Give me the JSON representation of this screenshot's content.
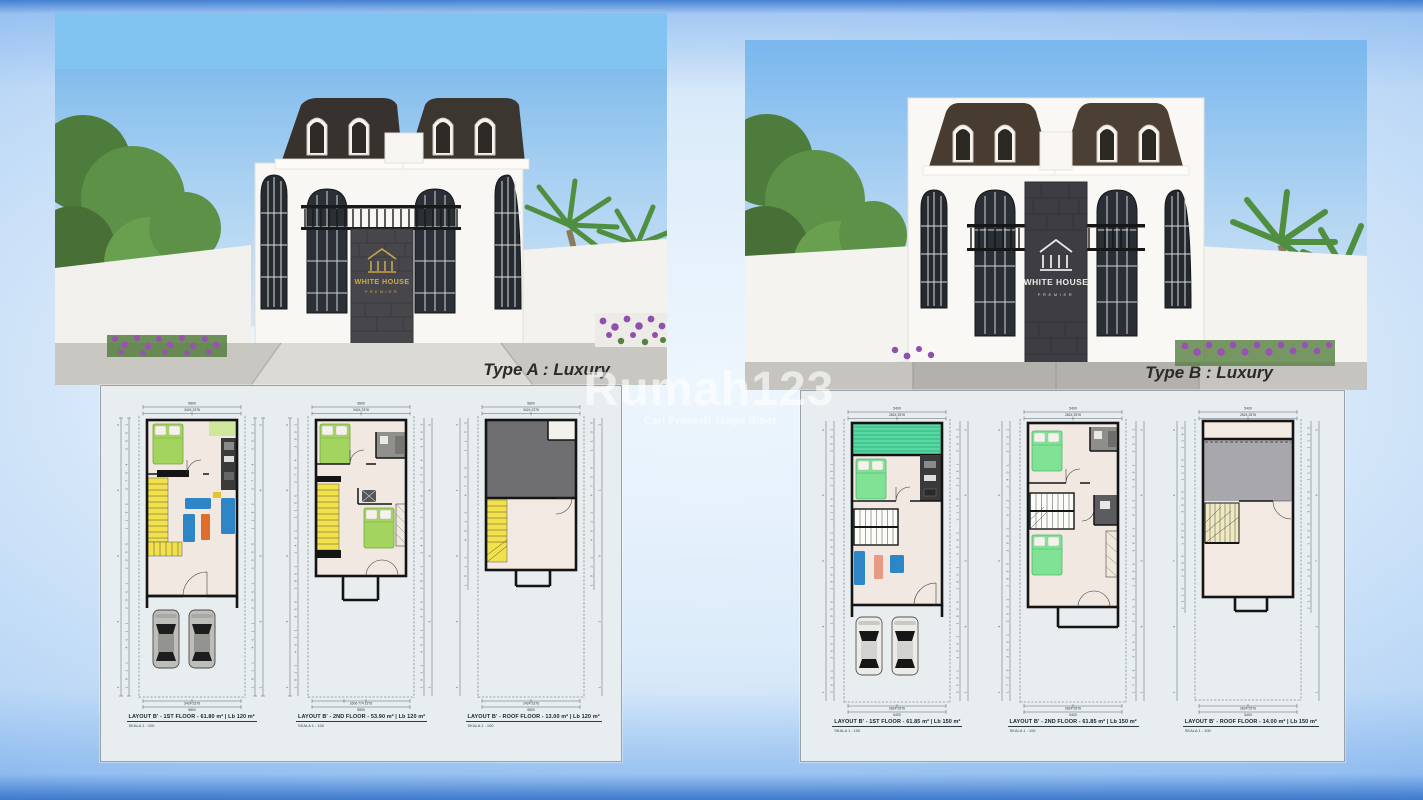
{
  "watermark": {
    "text": "Rumah123",
    "tagline": "Cari Properti Tanpa Ribet"
  },
  "panels": [
    {
      "id": "type-a",
      "caption": "Type A : Luxury",
      "logo": {
        "line1": "WHITE HOUSE",
        "line2": "PREMIER"
      },
      "plans": [
        {
          "label": "LAYOUT B' - 1ST FLOOR - 61.80 m² | Lb 120 m²",
          "scale": "SKALA 1 : 100",
          "dims": {
            "top": "5800",
            "tops": "3424          2376",
            "side_total": "15040",
            "side": "1911  4011  2001  3050  1150  2704  3001",
            "bottoms": "3424          2376",
            "bottom": "5800"
          }
        },
        {
          "label": "LAYOUT B' - 2ND FLOOR - 53.90 m² | Lb 120 m²",
          "scale": "SKALA 1 : 100",
          "dims": {
            "top": "5800",
            "tops": "3424          2376",
            "side_total": "15040",
            "side": "1911  4011  550  2901  1401  1150  2704  3001",
            "bottoms": "1600     774     2276",
            "bottom": "5800"
          }
        },
        {
          "label": "LAYOUT B' - ROOF FLOOR - 13.00 m² | Lb 120 m²",
          "scale": "SKALA 1 : 100",
          "dims": {
            "top": "5800",
            "tops": "3424          2376",
            "side_total": "12011",
            "side": "1911  4011  4750  1150",
            "bottoms": "2424          2376",
            "bottom": "5800"
          }
        }
      ]
    },
    {
      "id": "type-b",
      "caption": "Type B : Luxury",
      "logo": {
        "line1": "WHITE HOUSE",
        "line2": "PREMIER"
      },
      "plans": [
        {
          "label": "LAYOUT B' - 1ST FLOOR - 61.85 m² | Lb 150 m²",
          "scale": "SKALA 1 : 100",
          "dims": {
            "top": "5400",
            "tops": "2824          2576",
            "side_total": "14240",
            "side": "2031  3001  1950  1901  3001  1150  2251  2051",
            "bottoms": "2824          2576",
            "bottom": "5400"
          }
        },
        {
          "label": "LAYOUT B' - 2ND FLOOR - 61.85 m² | Lb 150 m²",
          "scale": "SKALA 1 : 100",
          "dims": {
            "top": "5400",
            "tops": "2824          2576",
            "side_total": "14240",
            "side": "1725  3001  2031  1950  3001  612  1401  2251",
            "bottoms": "2824          2576",
            "bottom": "5400"
          }
        },
        {
          "label": "LAYOUT B' - ROOF FLOOR - 14.00 m² | Lb 150 m²",
          "scale": "SKALA 1 : 100",
          "dims": {
            "top": "5400",
            "tops": "2824          2576",
            "side_total": "12740",
            "side": "2110  3000  1950  3000  1150  1190",
            "bottoms": "2824          2576",
            "bottom": "5400"
          }
        }
      ]
    }
  ],
  "colors": {
    "sky": "#7cbcf0",
    "roof_a": "#37322d",
    "roof_b": "#483c30",
    "gold_logo": "#c9a44a",
    "white_logo": "#efece6",
    "bed_green_a": "#a2d45f",
    "bed_green_b": "#7fe294",
    "stairs_yellow": "#f2e14b",
    "sofa_blue": "#2f86c6",
    "table_orange": "#df6e2c",
    "garden_teal": "#58d8a3"
  }
}
